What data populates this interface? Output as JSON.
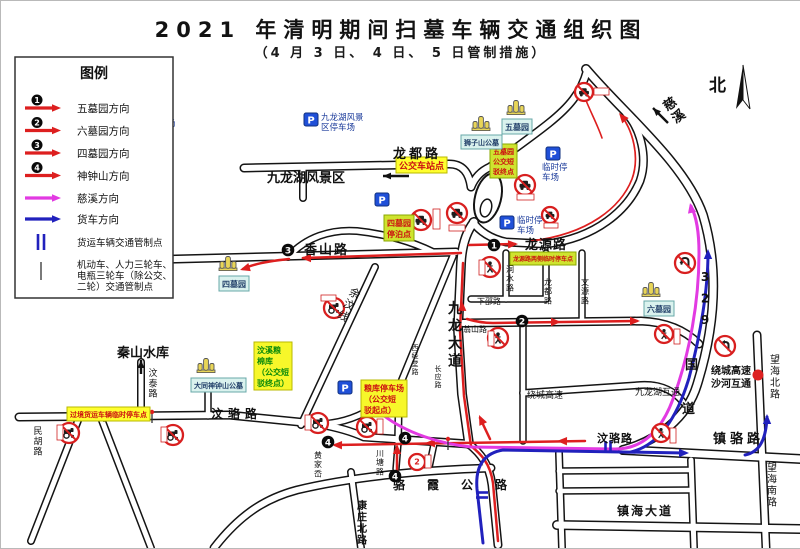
{
  "title": "2021 年清明期间扫墓车辆交通组织图",
  "subtitle": "（4 月 3 日、 4 日、 5 日管制措施）",
  "compass": {
    "label": "北"
  },
  "colors": {
    "route_red": "#dd1f1f",
    "route_magenta": "#e23ae2",
    "route_blue": "#2121bd",
    "road_casing": "#141414",
    "parking_blue": "#2050d8",
    "sign_red": "#d81f1f",
    "label_yellow_bg": "#ffff2e",
    "label_green_bg": "#cfe32f",
    "label_cyan_bg": "#daf2ee",
    "label_red_text": "#cc1111",
    "label_green_text": "#0a8a0a",
    "hub_dot": "#dd2222"
  },
  "legend": {
    "title": "图例",
    "items": [
      {
        "type": "num-arrow",
        "num": "1",
        "color": "#dd1f1f",
        "label": "五墓园方向"
      },
      {
        "type": "num-arrow",
        "num": "2",
        "color": "#dd1f1f",
        "label": "六墓园方向"
      },
      {
        "type": "num-arrow",
        "num": "3",
        "color": "#dd1f1f",
        "label": "四墓园方向"
      },
      {
        "type": "num-arrow",
        "num": "4",
        "color": "#dd1f1f",
        "label": "神钟山方向"
      },
      {
        "type": "arrow",
        "color": "#e23ae2",
        "label": "慈溪方向"
      },
      {
        "type": "arrow",
        "color": "#2121bd",
        "label": "货车方向"
      },
      {
        "type": "bars",
        "color": "#2121bd",
        "label": "货运车辆交通管制点",
        "lines": [
          "货运车辆交通管制点"
        ]
      },
      {
        "type": "tick",
        "color": "#333333",
        "label": "机动车、人力三轮车、电瓶三轮车（除公交、二轮）交通管制点",
        "lines": [
          "机动车、人力三轮车、",
          "电瓶三轮车（除公交、",
          "二轮）交通管制点"
        ]
      }
    ]
  },
  "map": {
    "roads": [
      {
        "d": "M585,68 C622,112 684,162 702,214 C717,264 716,320 696,384 C686,417 656,440 622,449",
        "w": 7
      },
      {
        "d": "M622,449 L800,458",
        "w": 7
      },
      {
        "d": "M756,334 L765,547",
        "w": 6
      },
      {
        "d": "M18,416 L228,414 L318,423 C340,427 352,431 363,436 L468,443",
        "w": 6
      },
      {
        "d": "M497,544 L491,484 C488,462 479,452 468,443",
        "w": 6
      },
      {
        "d": "M468,443 L461,393 L457,328 L460,262 C461,242 466,230 473,221",
        "w": 7
      },
      {
        "d": "M243,167 L448,163 C462,163 468,172 470,186",
        "w": 6
      },
      {
        "d": "M302,166 L302,197",
        "w": 5
      },
      {
        "d": "M470,186 C474,176 480,170 489,166 C510,150 532,135 548,122 C568,106 580,92 586,70",
        "w": 6
      },
      {
        "d": "M55,261 L455,251",
        "w": 6
      },
      {
        "d": "M287,256 C305,236 330,228 356,230 C385,233 412,241 432,251",
        "w": 5
      },
      {
        "d": "M472,221 C478,230 490,238 505,241 L545,243",
        "w": 6
      },
      {
        "d": "M545,243 C595,237 627,209 639,180 C647,157 640,128 625,112",
        "w": 6
      },
      {
        "d": "M462,322 L640,320 C666,321 685,330 698,343",
        "w": 6
      },
      {
        "d": "M505,252 L505,298",
        "w": 4.5
      },
      {
        "d": "M470,298 L545,298",
        "w": 4.5
      },
      {
        "d": "M581,252 L581,320",
        "w": 4.5
      },
      {
        "d": "M545,252 L545,298",
        "w": 4.5
      },
      {
        "d": "M522,322 L522,440",
        "w": 4.5
      },
      {
        "d": "M522,392 L640,384 C662,383 674,391 682,401",
        "w": 5
      },
      {
        "d": "M374,266 L300,424",
        "w": 5
      },
      {
        "d": "M452,255 L398,386",
        "w": 5
      },
      {
        "d": "M398,386 L370,408 C350,420 330,424 310,423",
        "w": 5
      },
      {
        "d": "M398,386 L397,443",
        "w": 5
      },
      {
        "d": "M140,361 L140,415",
        "w": 5
      },
      {
        "d": "M207,390 L207,415",
        "w": 4.5
      },
      {
        "d": "M78,417 L30,540",
        "w": 5
      },
      {
        "d": "M100,417 L150,547",
        "w": 5
      },
      {
        "d": "M213,547 C240,512 266,497 296,489 C350,476 420,469 490,467",
        "w": 6
      },
      {
        "d": "M397,443 L395,468",
        "w": 4.5
      },
      {
        "d": "M433,443 L428,467",
        "w": 4.5
      },
      {
        "d": "M350,471 L360,547",
        "w": 5
      },
      {
        "d": "M558,452 L561,547",
        "w": 5
      },
      {
        "d": "M690,459 L693,547",
        "w": 5
      },
      {
        "d": "M558,470 L688,469",
        "w": 4.5
      },
      {
        "d": "M558,490 L688,489",
        "w": 4.5
      },
      {
        "d": "M556,524 L800,528",
        "w": 7
      }
    ],
    "routes": [
      {
        "name": "route-simuyuan-xiangshan",
        "color": "#dd1f1f",
        "w": 2.5,
        "d": "M460,252 L302,257",
        "arrows": [
          [
            300,
            257,
            180
          ]
        ]
      },
      {
        "name": "route-simuyuan-end",
        "color": "#dd1f1f",
        "w": 2.5,
        "d": "M288,258 C268,260 252,263 242,268",
        "arrows": [
          [
            239,
            269,
            163
          ]
        ]
      },
      {
        "name": "route-wumuyuan-longyuan",
        "color": "#dd1f1f",
        "w": 2.5,
        "d": "M468,244 L514,243",
        "arrows": [
          [
            517,
            243,
            -2
          ]
        ]
      },
      {
        "name": "route-wumuyuan-north",
        "color": "#dd1f1f",
        "w": 1.7,
        "d": "M530,240 C588,233 620,206 631,178 C639,156 632,130 620,114",
        "arrows": [
          [
            618,
            112,
            -130
          ]
        ]
      },
      {
        "name": "route-liumuyuan",
        "color": "#dd1f1f",
        "w": 2.5,
        "d": "M466,318 C476,321 484,322 492,322 L636,320",
        "arrows": [
          [
            560,
            321,
            0
          ],
          [
            639,
            320,
            0
          ]
        ]
      },
      {
        "name": "route-main-south",
        "color": "#dd1f1f",
        "w": 2.5,
        "d": "M497,540 L492,482 C489,462 480,453 470,445 L463,395 L459,330 L462,262",
        "arrows": [
          [
            461,
            300,
            -91
          ]
        ]
      },
      {
        "name": "route-junction-up",
        "color": "#dd1f1f",
        "w": 2.5,
        "d": "M489,438 L479,417",
        "arrows": [
          [
            478,
            414,
            -115
          ]
        ]
      },
      {
        "name": "route-shenzhongshan-west",
        "color": "#dd1f1f",
        "w": 2.5,
        "d": "M584,440 L334,444",
        "arrows": [
          [
            556,
            440,
            181
          ],
          [
            424,
            442,
            181
          ],
          [
            331,
            444,
            181
          ]
        ]
      },
      {
        "name": "route-shenzhongshan-north",
        "color": "#dd1f1f",
        "w": 2.5,
        "d": "M396,471 L396,446",
        "arrows": [
          [
            396,
            443,
            -90
          ]
        ]
      },
      {
        "name": "route-red-top-dash",
        "color": "#dd1f1f",
        "w": 1.6,
        "d": "M584,97 C590,112 597,125 601,137",
        "arrows": []
      },
      {
        "name": "route-cixi",
        "color": "#e23ae2",
        "w": 3,
        "d": "M382,414 C405,432 440,443 470,446 L612,448 C643,449 661,428 672,398 C689,352 698,300 698,252 C698,232 696,217 690,205",
        "arrows": [
          [
            689,
            202,
            -102
          ]
        ]
      },
      {
        "name": "route-truck-main",
        "color": "#2121bd",
        "w": 3,
        "d": "M482,542 L476,488 C474,464 484,452 502,449 L684,452",
        "arrows": [
          [
            688,
            452,
            0
          ]
        ]
      },
      {
        "name": "route-truck-329",
        "color": "#2121bd",
        "w": 3,
        "d": "M630,451 C658,444 676,417 688,377 C700,332 707,287 707,252",
        "arrows": [
          [
            707,
            248,
            -90
          ]
        ]
      },
      {
        "name": "route-truck-wanghai",
        "color": "#2121bd",
        "w": 3,
        "d": "M744,454 C759,451 765,438 766,416",
        "arrows": [
          [
            766,
            413,
            -90
          ]
        ]
      }
    ],
    "labels": [
      {
        "t": "龙都路",
        "x": 392,
        "y": 157,
        "s": 13,
        "b": 1,
        "sp": 3
      },
      {
        "t": "九龙湖风景区",
        "x": 266,
        "y": 181,
        "s": 13,
        "b": 1
      },
      {
        "t": "香山路",
        "x": 303,
        "y": 253,
        "s": 13,
        "b": 1,
        "sp": 2
      },
      {
        "t": "龙源路",
        "x": 524,
        "y": 248,
        "s": 13,
        "b": 1,
        "sp": 1
      },
      {
        "t": "秦山水库",
        "x": 116,
        "y": 356,
        "s": 13,
        "b": 1
      },
      {
        "t": "汶骆路",
        "x": 210,
        "y": 417,
        "s": 12,
        "b": 1,
        "sp": 5
      },
      {
        "t": "骆霞公路",
        "x": 392,
        "y": 488,
        "s": 12,
        "b": 1,
        "sp": 22
      },
      {
        "t": "镇海大道",
        "x": 616,
        "y": 514,
        "s": 12,
        "b": 1,
        "sp": 2
      },
      {
        "t": "汶骆路",
        "x": 596,
        "y": 441,
        "s": 11,
        "b": 1,
        "sp": 1
      },
      {
        "t": "镇骆路",
        "x": 712,
        "y": 442,
        "s": 13,
        "b": 1,
        "sp": 4
      },
      {
        "t": "绕城高速",
        "x": 526,
        "y": 397,
        "s": 9
      },
      {
        "t": "九龙湖互通",
        "x": 634,
        "y": 394,
        "s": 9
      },
      {
        "t": "绕城高速",
        "x": 710,
        "y": 373,
        "s": 10,
        "b": 1
      },
      {
        "t": "沙河互通",
        "x": 710,
        "y": 386,
        "s": 10,
        "b": 1
      },
      {
        "t": "下邵路",
        "x": 476,
        "y": 303,
        "s": 8
      },
      {
        "t": "翁山路",
        "x": 462,
        "y": 331,
        "s": 8
      },
      {
        "t": "国",
        "x": 684,
        "y": 368,
        "s": 13,
        "b": 1
      },
      {
        "t": "道",
        "x": 681,
        "y": 412,
        "s": 13,
        "b": 1
      },
      {
        "t": "北",
        "x": 708,
        "y": 90,
        "s": 17,
        "b": 1
      },
      {
        "t": "九龙大道",
        "x": 454,
        "y": 298,
        "s": 14,
        "b": 1,
        "v": 1,
        "lh": 1.25
      },
      {
        "t": "汶泰路",
        "x": 152,
        "y": 366,
        "s": 9,
        "v": 1
      },
      {
        "t": "民胡路",
        "x": 37,
        "y": 424,
        "s": 9,
        "v": 1
      },
      {
        "t": "康庄北路",
        "x": 361,
        "y": 498,
        "s": 10,
        "b": 1,
        "v": 1
      },
      {
        "t": "川塘路",
        "x": 379,
        "y": 447,
        "s": 8,
        "v": 1
      },
      {
        "t": "黄家岙",
        "x": 317,
        "y": 449,
        "s": 8,
        "v": 1
      },
      {
        "t": "西经堂路",
        "x": 414,
        "y": 342,
        "s": 7,
        "v": 1
      },
      {
        "t": "长应路",
        "x": 437,
        "y": 363,
        "s": 7,
        "v": 1
      },
      {
        "t": "望海北路",
        "x": 774,
        "y": 352,
        "s": 10,
        "v": 1
      },
      {
        "t": "望海南路",
        "x": 771,
        "y": 460,
        "s": 10,
        "v": 1
      },
      {
        "t": "洞水路",
        "x": 509,
        "y": 263,
        "s": 8,
        "v": 1
      },
      {
        "t": "文源路",
        "x": 584,
        "y": 276,
        "s": 8,
        "v": 1
      },
      {
        "t": "龙都路",
        "x": 547,
        "y": 276,
        "s": 8,
        "v": 1
      },
      {
        "t": "329",
        "x": 704,
        "y": 268,
        "s": 12,
        "b": 1,
        "v": 1,
        "lh": 1.8
      },
      {
        "t": "慈溪",
        "x": 664,
        "y": 96,
        "s": 13,
        "b": 1,
        "v": 1,
        "r": -35
      },
      {
        "t": "余汶线",
        "x": 357,
        "y": 286,
        "s": 11,
        "v": 1,
        "r": 27
      }
    ],
    "boxes": [
      {
        "lines": [
          "公交车站点"
        ],
        "x": 395,
        "y": 156,
        "s": 9,
        "bg": "#ffff2e",
        "fg": "#cc1111",
        "bd": "#b9b900"
      },
      {
        "lines": [
          "四墓园",
          "停泊点"
        ],
        "x": 383,
        "y": 214,
        "s": 8,
        "bg": "#cfe32f",
        "fg": "#cc1111",
        "bd": "#8aa800"
      },
      {
        "lines": [
          "五墓园",
          "公交短",
          "驳终点"
        ],
        "x": 489,
        "y": 143,
        "s": 7,
        "bg": "#cfe32f",
        "fg": "#cc1111",
        "bd": "#8aa800"
      },
      {
        "lines": [
          "粮库停车场",
          "（公交短",
          "驳起点）"
        ],
        "x": 360,
        "y": 379,
        "s": 8,
        "bg": "#f7f72a",
        "fg": "#cc1111",
        "bd": "#b9b900"
      },
      {
        "lines": [
          "汶溪粮",
          "棉库",
          "（公交短",
          "驳终点）"
        ],
        "x": 253,
        "y": 341,
        "s": 8,
        "bg": "#f7f72a",
        "fg": "#0a8a0a",
        "bd": "#b9b900"
      },
      {
        "lines": [
          "过境货运车辆临时停车点"
        ],
        "x": 66,
        "y": 406,
        "s": 7,
        "bg": "#ffff2e",
        "fg": "#cc1111",
        "bd": "#b9b900"
      },
      {
        "lines": [
          "龙源路两侧临时停车点"
        ],
        "x": 509,
        "y": 251,
        "s": 6,
        "bg": "#cfe32f",
        "fg": "#cc1111",
        "bd": "#8aa800"
      },
      {
        "lines": [
          "五墓园"
        ],
        "x": 501,
        "y": 118,
        "s": 8,
        "bg": "#daf2ee",
        "fg": "#22406a",
        "bd": "#68a8a8"
      },
      {
        "lines": [
          "狮子山公墓"
        ],
        "x": 460,
        "y": 134,
        "s": 7,
        "bg": "#daf2ee",
        "fg": "#22406a",
        "bd": "#68a8a8"
      },
      {
        "lines": [
          "六墓园"
        ],
        "x": 643,
        "y": 300,
        "s": 8,
        "bg": "#daf2ee",
        "fg": "#22406a",
        "bd": "#68a8a8"
      },
      {
        "lines": [
          "四墓园"
        ],
        "x": 218,
        "y": 275,
        "s": 8,
        "bg": "#daf2ee",
        "fg": "#22406a",
        "bd": "#68a8a8"
      },
      {
        "lines": [
          "大同神钟山公墓"
        ],
        "x": 190,
        "y": 377,
        "s": 7,
        "bg": "#daf2ee",
        "fg": "#22406a",
        "bd": "#68a8a8"
      }
    ],
    "parkings": [
      {
        "x": 122,
        "y": 124,
        "label": [
          "党校停车场"
        ],
        "pos": "right"
      },
      {
        "x": 310,
        "y": 118,
        "label": [
          "九龙湖风景",
          "区停车场"
        ],
        "pos": "right"
      },
      {
        "x": 552,
        "y": 152,
        "label": [
          "临时停",
          "车场"
        ],
        "pos": "below"
      },
      {
        "x": 506,
        "y": 221,
        "label": [
          "临时停",
          "车场"
        ],
        "pos": "right"
      },
      {
        "x": 381,
        "y": 198,
        "label": [],
        "pos": "right"
      },
      {
        "x": 344,
        "y": 386,
        "label": [],
        "pos": "right"
      }
    ],
    "cemetery_icons": [
      {
        "x": 515,
        "y": 108
      },
      {
        "x": 480,
        "y": 124
      },
      {
        "x": 650,
        "y": 290
      },
      {
        "x": 227,
        "y": 264
      },
      {
        "x": 205,
        "y": 366
      }
    ],
    "signs": [
      {
        "type": "car",
        "x": 420,
        "y": 219,
        "r": 10
      },
      {
        "type": "car",
        "x": 456,
        "y": 212,
        "r": 10
      },
      {
        "type": "car",
        "x": 524,
        "y": 184,
        "r": 10
      },
      {
        "type": "car",
        "x": 549,
        "y": 214,
        "r": 8
      },
      {
        "type": "car",
        "x": 583,
        "y": 91,
        "r": 9
      },
      {
        "type": "pedestrian",
        "x": 489,
        "y": 266,
        "r": 10
      },
      {
        "type": "pedestrian",
        "x": 497,
        "y": 337,
        "r": 10
      },
      {
        "type": "pedestrian",
        "x": 663,
        "y": 333,
        "r": 9
      },
      {
        "type": "pedestrian",
        "x": 660,
        "y": 432,
        "r": 9
      },
      {
        "type": "tractor",
        "x": 333,
        "y": 307,
        "r": 10
      },
      {
        "type": "tractor",
        "x": 317,
        "y": 422,
        "r": 10
      },
      {
        "type": "tractor",
        "x": 366,
        "y": 426,
        "r": 10
      },
      {
        "type": "tractor",
        "x": 68,
        "y": 432,
        "r": 10
      },
      {
        "type": "tractor",
        "x": 172,
        "y": 434,
        "r": 10
      },
      {
        "type": "noleft",
        "x": 724,
        "y": 345,
        "r": 10
      },
      {
        "type": "nou",
        "x": 684,
        "y": 262,
        "r": 10
      },
      {
        "type": "num2",
        "x": 416,
        "y": 461,
        "r": 8
      }
    ],
    "miniboxes": [
      [
        432,
        208,
        7,
        20
      ],
      [
        448,
        224,
        16,
        6
      ],
      [
        516,
        193,
        17,
        6
      ],
      [
        543,
        222,
        14,
        5
      ],
      [
        593,
        87,
        15,
        7
      ],
      [
        478,
        259,
        6,
        15
      ],
      [
        487,
        330,
        6,
        15
      ],
      [
        673,
        328,
        6,
        15
      ],
      [
        669,
        427,
        6,
        15
      ],
      [
        320,
        294,
        15,
        6
      ],
      [
        304,
        414,
        6,
        15
      ],
      [
        376,
        418,
        6,
        15
      ],
      [
        56,
        424,
        6,
        15
      ],
      [
        160,
        426,
        6,
        15
      ],
      [
        424,
        454,
        6,
        13
      ]
    ],
    "badges": [
      {
        "n": "3",
        "x": 287,
        "y": 249
      },
      {
        "n": "1",
        "x": 493,
        "y": 244
      },
      {
        "n": "2",
        "x": 521,
        "y": 320
      },
      {
        "n": "4",
        "x": 327,
        "y": 441
      },
      {
        "n": "4",
        "x": 404,
        "y": 437
      },
      {
        "n": "4",
        "x": 394,
        "y": 475
      }
    ],
    "ticks": [
      [
        103,
        414
      ],
      [
        151,
        415
      ],
      [
        318,
        425
      ],
      [
        366,
        429
      ],
      [
        447,
        442
      ]
    ],
    "freight_bars": [
      [
        607,
        446,
        0
      ],
      [
        481,
        494,
        90
      ]
    ],
    "black_arrows": [
      [
        408,
        175,
        382,
        175
      ],
      [
        140,
        373,
        140,
        359
      ],
      [
        667,
        122,
        652,
        107
      ]
    ],
    "dots": [
      {
        "x": 757,
        "y": 374,
        "r": 5.5
      }
    ],
    "oval": {
      "cx": 487,
      "cy": 197,
      "rx": 13,
      "ry": 25,
      "rot": 14,
      "icx": 485,
      "icy": 207,
      "irx": 5.5,
      "iry": 9
    }
  }
}
